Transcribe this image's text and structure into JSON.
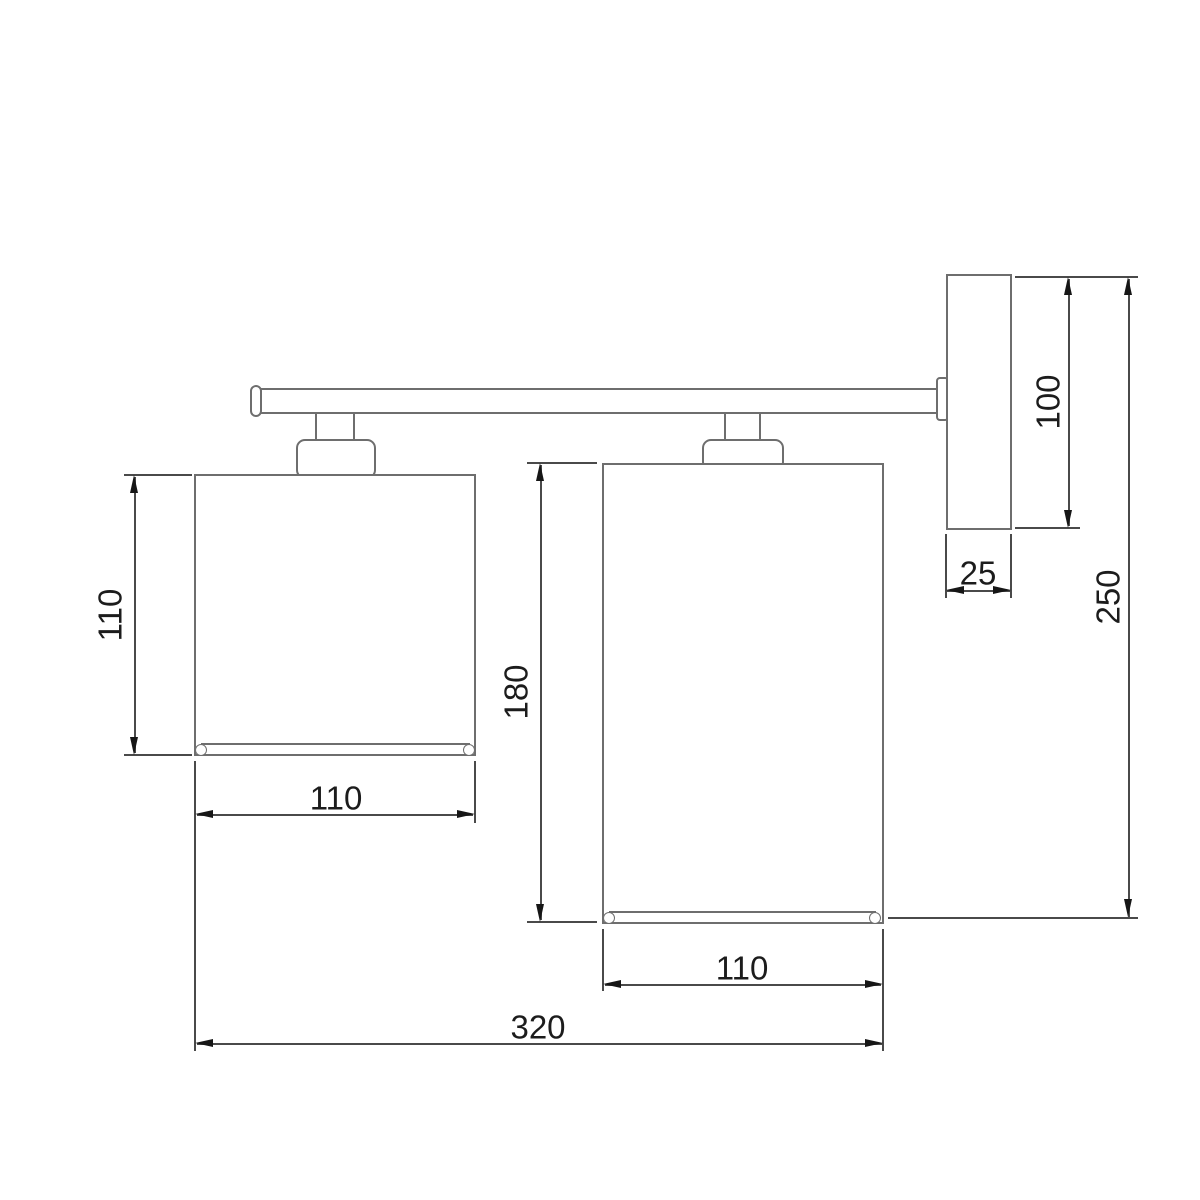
{
  "drawing": {
    "kind": "technical-dimension-drawing",
    "subject": "two-shade wall sconce, side elevation with dimensions",
    "units": "mm",
    "colors": {
      "background": "#ffffff",
      "object_line": "#6e6e6e",
      "dimension_line": "#4a4a4a",
      "arrow": "#161616",
      "text": "#1c1c1c"
    },
    "labels": {
      "left_shade_height": "110",
      "left_shade_width": "110",
      "right_shade_height": "180",
      "right_shade_width": "110",
      "total_width": "320",
      "backplate_height": "100",
      "backplate_depth": "25",
      "total_height": "250"
    }
  }
}
